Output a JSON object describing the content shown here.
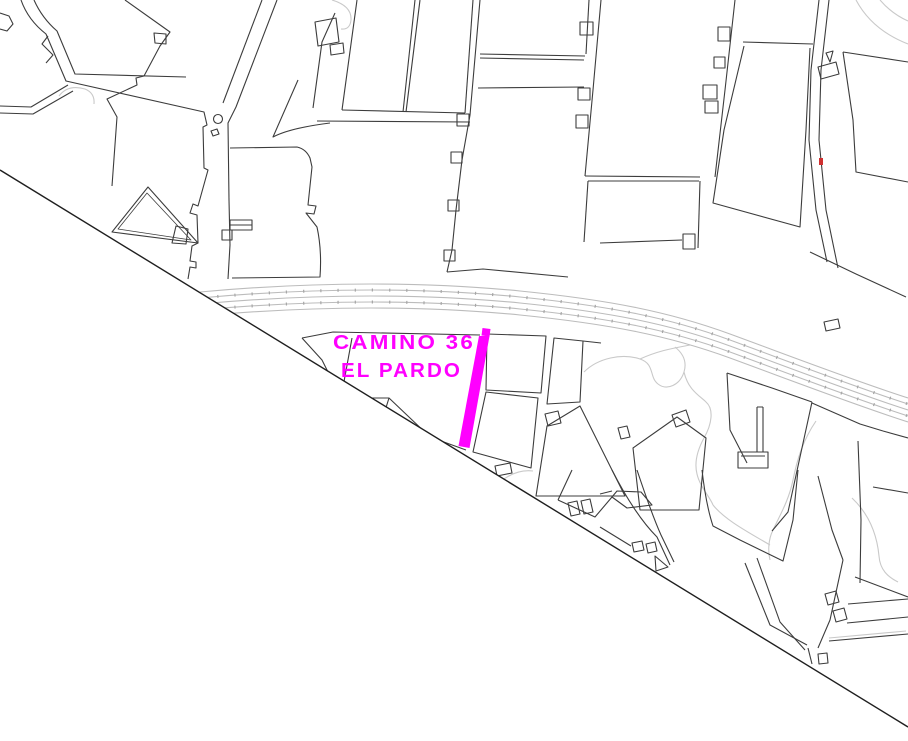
{
  "map": {
    "type": "cadastral-parcel-map",
    "labels": {
      "line1": "CAMINO 36",
      "line2": "EL PARDO"
    },
    "highlight": {
      "feature": "selected-road-segment",
      "color": "#ff00ff"
    },
    "colors": {
      "background": "#ffffff",
      "parcel": "#3c3c3c",
      "boundary": "#1f1f1f",
      "road": "#bcbcbc",
      "road_tick": "#a6a6a6",
      "contour": "#c9c9c9",
      "marker": "#d03030"
    }
  }
}
